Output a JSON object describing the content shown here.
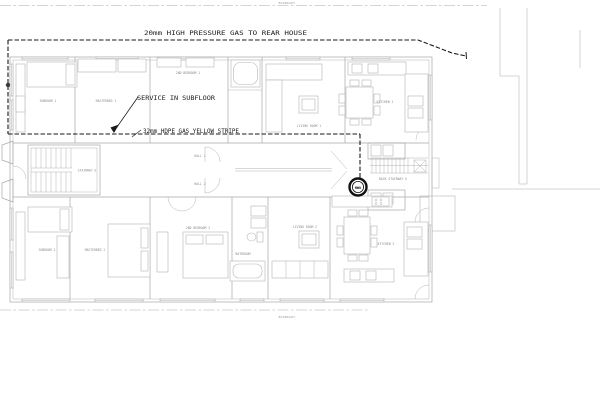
{
  "boundary": {
    "label": "BOUNDARY"
  },
  "gas": {
    "high_pressure_label": "20mm HIGH PRESSURE GAS TO REAR HOUSE",
    "service_label": "SERVICE IN SUBFLOOR",
    "hdpe_label": "32mm HDPE GAS YELLOW STRIPE",
    "hwu_label": "HWU"
  },
  "rooms": {
    "sunroom_1": "SUNROOM 1",
    "masterbed_1": "MASTERBED 1",
    "second_bedroom_1": "2ND BEDROOM 1",
    "living_room_1": "LIVING ROOM 1",
    "kitchen_1": "KITCHEN 1",
    "hall_1": "HALL 1",
    "hall_2": "HALL 2",
    "stairway": "STAIRWAY G",
    "back_stairway": "BACK STAIRWAY G",
    "sunroom_2": "SUNROOM 2",
    "masterbed_2": "MASTERBED 2",
    "second_bedroom_2": "2ND BEDROOM 2",
    "bathroom_2": "BATHROOM",
    "living_room_2": "LIVING ROOM 2",
    "kitchen_2": "KITCHEN 2"
  },
  "colors": {
    "background": "#ffffff",
    "gas_line": "#1a1a1a",
    "plan_line": "#a8a8a8",
    "furniture_line": "#b5b5b5",
    "site_line": "#c8c8c8",
    "room_label": "#8c8c8c"
  }
}
